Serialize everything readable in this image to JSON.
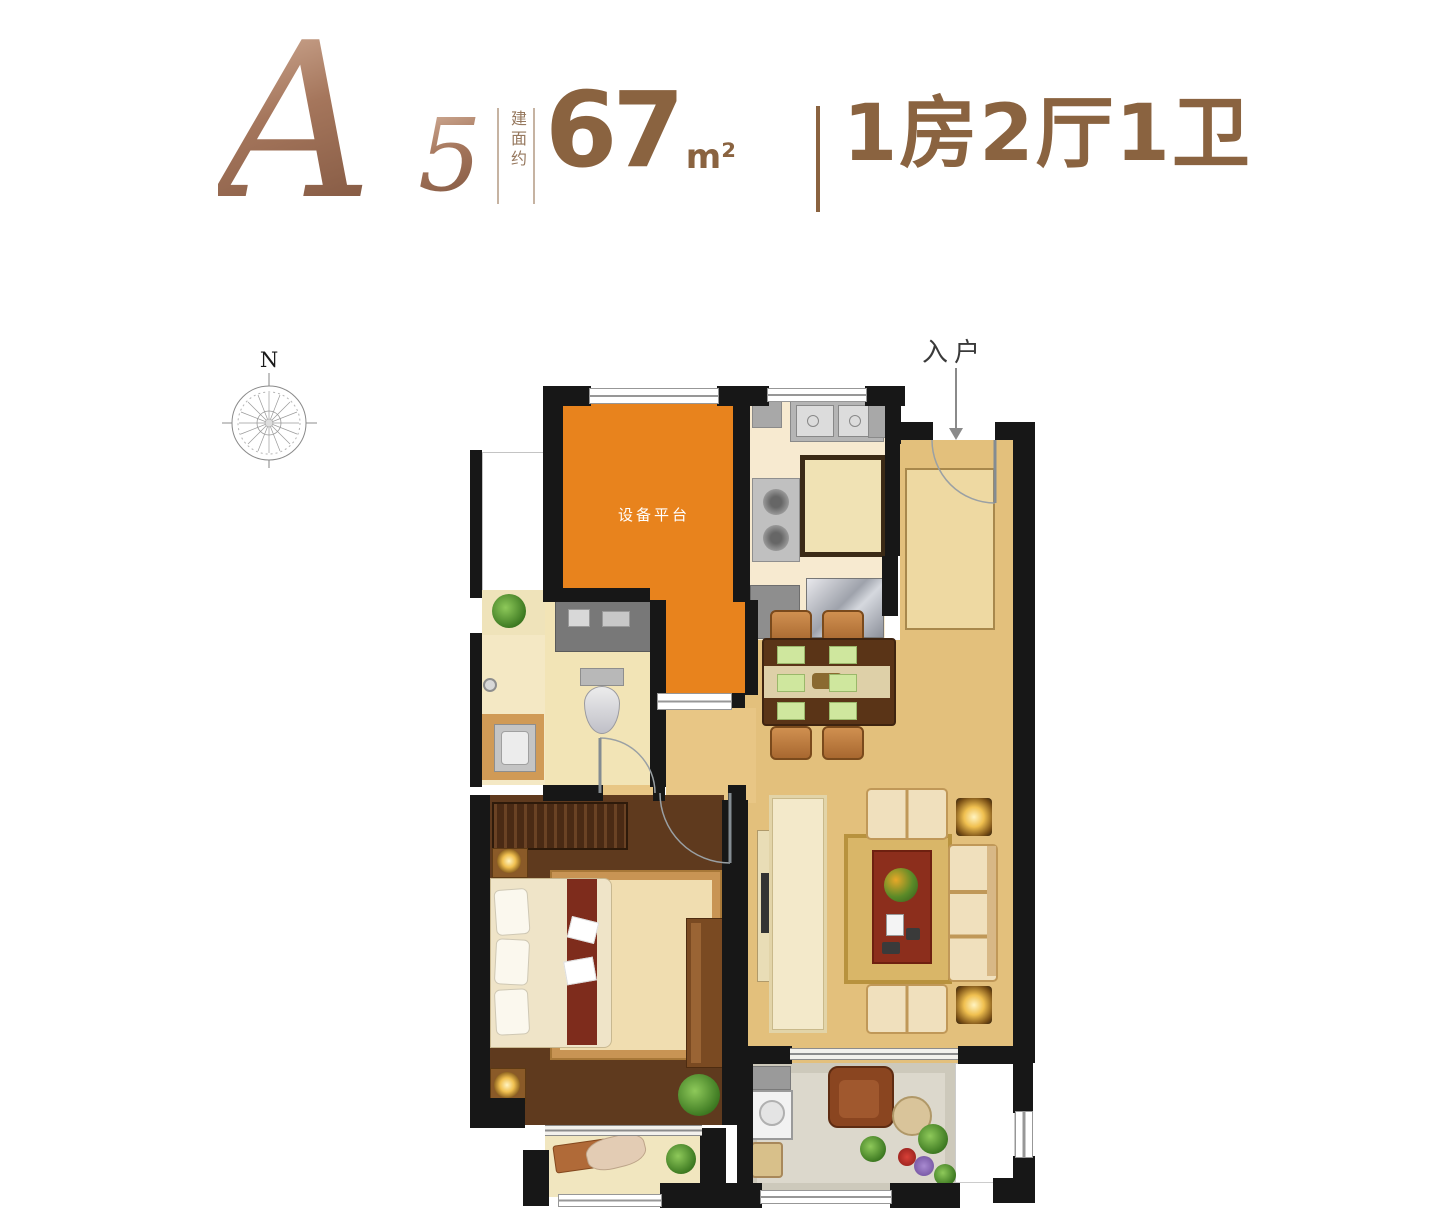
{
  "header": {
    "plan_code_letter": "A",
    "plan_code_number": "5",
    "area_prefix": "建面约",
    "area_value": "67",
    "area_unit": "m²",
    "layout_text": "1房2厅1卫",
    "accent_color": "#8a6340",
    "script_color": "#a5765c"
  },
  "compass": {
    "label": "N"
  },
  "floor_plan": {
    "entry_label": "入户",
    "labels": {
      "equipment_platform": "设备平台"
    },
    "colors": {
      "wall": "#171717",
      "equipment_platform": "#e8831d",
      "kitchen_floor": "#f7ead0",
      "living_wood_floor": "#e3c07c",
      "bedroom_floor": "#5f3a1e",
      "bathroom_tile": "#f2e4b6",
      "balcony_tile": "#dcd8cc",
      "bay_floor": "#f1e6bf",
      "rug_red": "#8c2e1c",
      "rug_gold": "#d9b668"
    }
  }
}
